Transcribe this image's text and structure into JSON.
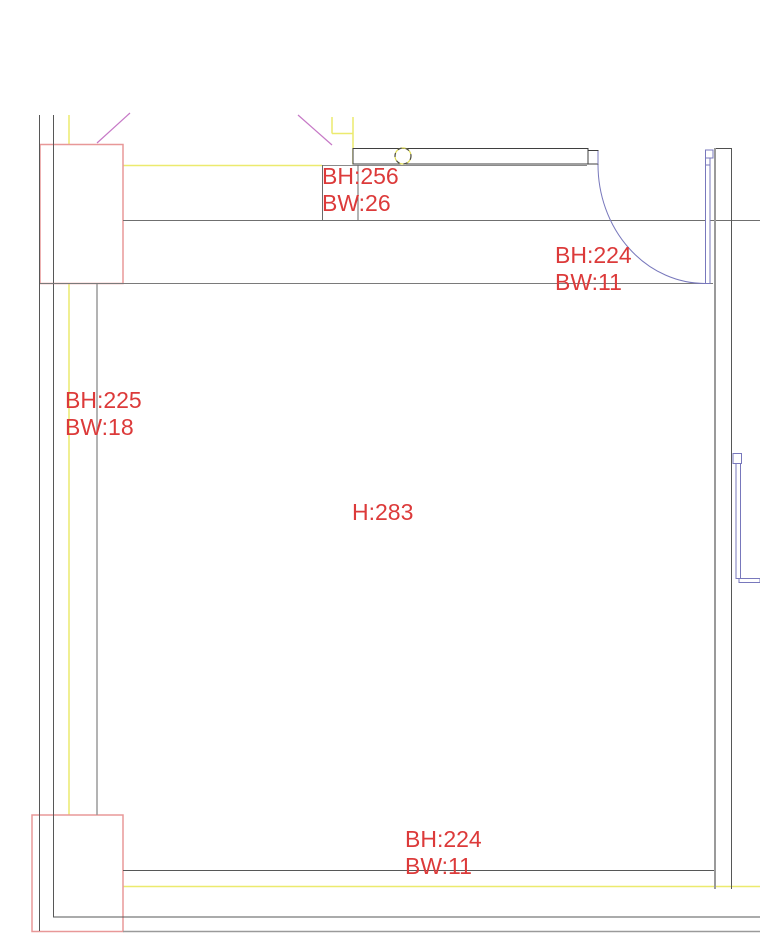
{
  "annotations": {
    "beam_top": {
      "line1": "BH:256",
      "line2": "BW:26"
    },
    "beam_right": {
      "line1": "BH:224",
      "line2": "BW:11"
    },
    "beam_left": {
      "line1": "BH:225",
      "line2": "BW:18"
    },
    "room_height": {
      "line1": "H:283"
    },
    "beam_bottom": {
      "line1": "BH:224",
      "line2": "BW:11"
    }
  },
  "colors": {
    "annotation_red": "#dc3a3a",
    "column_red": "#e89898",
    "beam_yellow": "#ecea6e",
    "door_blue": "#7878bc",
    "section_magenta": "#c678c6",
    "wall_dark": "#565757",
    "wall_gray": "#9a9a9a"
  }
}
